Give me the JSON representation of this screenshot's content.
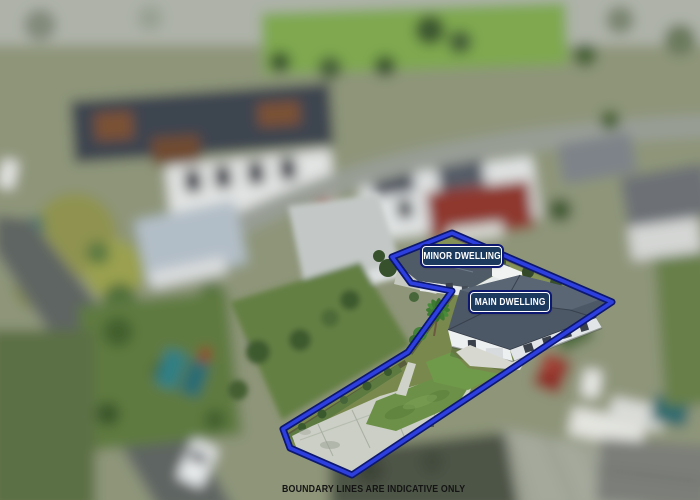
{
  "labels": {
    "minor": "MINOR DWELLING",
    "main": "MAIN DWELLING"
  },
  "disclaimer": "BOUNDARY LINES ARE INDICATIVE ONLY",
  "boundary": {
    "points_str": "452,233 612,302 352,475 290,448 283,429 408,352 452,291 411,283 392,257",
    "stroke_color": "#2e3fe0",
    "edge_color": "#0d1870"
  },
  "colors": {
    "label-bg": "#1c3a5e",
    "label-border": "#ffffff",
    "label-text": "#ffffff",
    "disclaimer": "#141414",
    "boundary-fill": "#2e3fe0",
    "boundary-edge": "#0d1870",
    "main-roof": "#4d5867",
    "house-wall": "#edf0f1",
    "lawn": "#6d9048",
    "driveway-concrete": "#cbcfc5",
    "asphalt-road": "#5f6562"
  }
}
